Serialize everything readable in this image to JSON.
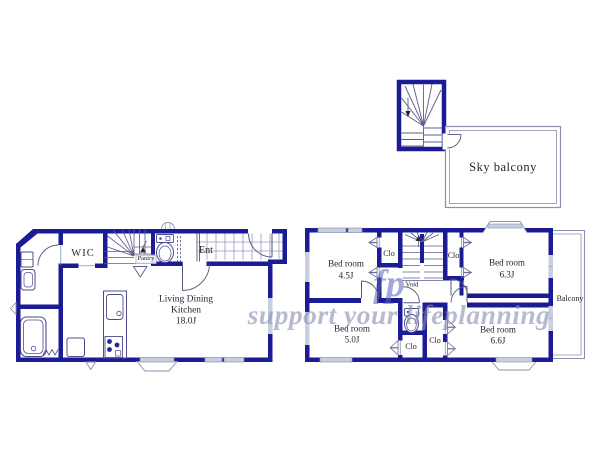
{
  "colors": {
    "wall": "#1b1b96",
    "fixture_line": "#4c4c8e",
    "thin_line": "#8a90ad",
    "tile_grid": "#9a9ac2",
    "window_fill": "#c9cfe0",
    "label_text": "#26262e",
    "watermark_logo": "#5663b6",
    "watermark_tagline": "#868db0"
  },
  "sky_balcony": {
    "label": "Sky balcony"
  },
  "floor1": {
    "wic": "WIC",
    "ent": "Ent",
    "pantry": "Pantry",
    "ldk": {
      "line1": "Living Dining",
      "line2": "Kitchen",
      "size": "18.0J"
    }
  },
  "floor2": {
    "bedrooms": [
      {
        "label": "Bed room",
        "size": "4.5J"
      },
      {
        "label": "Bed room",
        "size": "6.3J"
      },
      {
        "label": "Bed room",
        "size": "5.0J"
      },
      {
        "label": "Bed room",
        "size": "6.6J"
      }
    ],
    "closets": [
      "Clo",
      "Clo",
      "Clo",
      "Clo"
    ],
    "void_label": "Void",
    "balcony_label": "Balcony"
  },
  "watermark": {
    "logo": "fp",
    "tagline": "support your lifeplanning"
  }
}
